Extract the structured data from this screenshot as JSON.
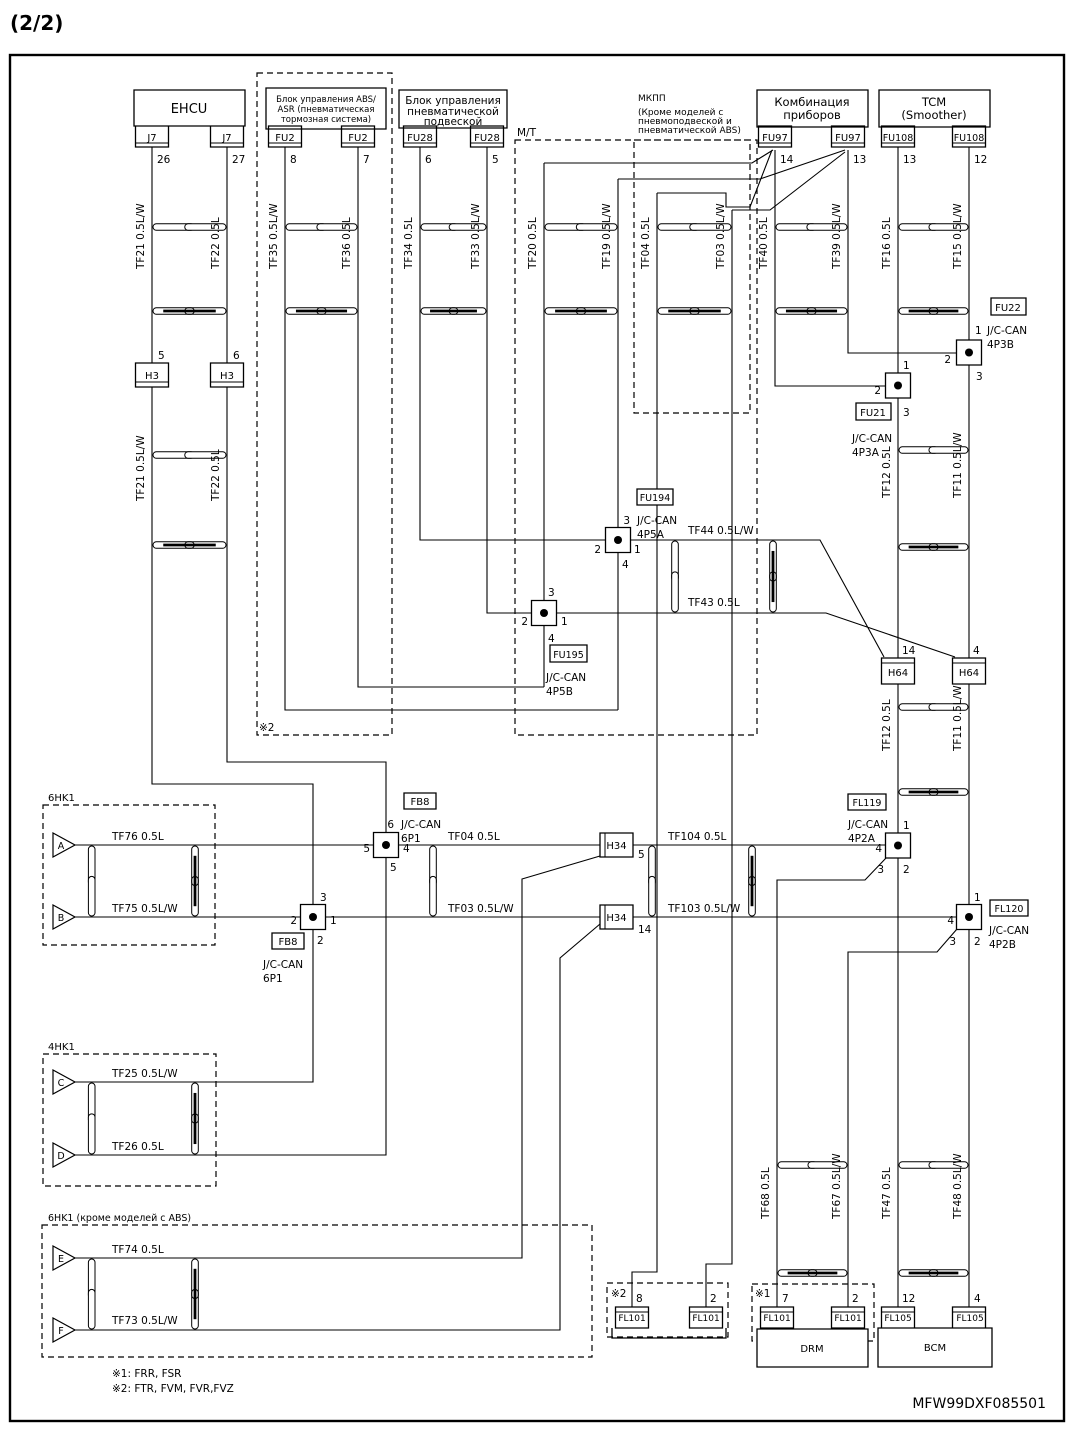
{
  "labels": [
    {
      "n": "sheet-number",
      "t": "(2/2)",
      "x": 10,
      "y": 30,
      "s": 20,
      "b": 1
    },
    {
      "n": "ehcu-label",
      "t": "EHCU",
      "x": 189,
      "y": 113,
      "a": "m",
      "s": 13
    },
    {
      "n": "abs-unit-line1",
      "t": "Блок управления ABS/",
      "x": 326,
      "y": 102,
      "a": "m",
      "s": 8.5
    },
    {
      "n": "abs-unit-line2",
      "t": "ASR (пневматическая",
      "x": 326,
      "y": 112,
      "a": "m",
      "s": 8.5
    },
    {
      "n": "abs-unit-line3",
      "t": "тормозная система)",
      "x": 326,
      "y": 122,
      "a": "m",
      "s": 8.5
    },
    {
      "n": "susp-unit-line1",
      "t": "Блок управления",
      "x": 453,
      "y": 104,
      "a": "m",
      "s": 10.5
    },
    {
      "n": "susp-unit-line2",
      "t": "пневматической",
      "x": 453,
      "y": 115,
      "a": "m",
      "s": 10.5
    },
    {
      "n": "susp-unit-line3",
      "t": "подвеской",
      "x": 453,
      "y": 125,
      "a": "m",
      "s": 10.5
    },
    {
      "n": "cluster-line1",
      "t": "Комбинация",
      "x": 812,
      "y": 106,
      "a": "m",
      "s": 11.5
    },
    {
      "n": "cluster-line2",
      "t": "приборов",
      "x": 812,
      "y": 119,
      "a": "m",
      "s": 11.5
    },
    {
      "n": "tcm-line1",
      "t": "TCM",
      "x": 934,
      "y": 106,
      "a": "m",
      "s": 11.5
    },
    {
      "n": "tcm-line2",
      "t": "(Smoother)",
      "x": 934,
      "y": 119,
      "a": "m",
      "s": 11.5
    },
    {
      "n": "mt-option-label",
      "t": "М/Т",
      "x": 517,
      "y": 136
    },
    {
      "n": "mkpp-option-line1",
      "t": "МКПП",
      "x": 638,
      "y": 101,
      "s": 9
    },
    {
      "n": "mkpp-option-line2",
      "t": "(Кроме моделей с",
      "x": 638,
      "y": 115,
      "s": 9
    },
    {
      "n": "mkpp-option-line3",
      "t": "пневмоподвеской и",
      "x": 638,
      "y": 124,
      "s": 9
    },
    {
      "n": "mkpp-option-line4",
      "t": "пневматической ABS)",
      "x": 638,
      "y": 133,
      "s": 9
    },
    {
      "n": "connector-j7-a",
      "t": "J7",
      "x": 152,
      "y": 141,
      "a": "m",
      "s": 10
    },
    {
      "n": "connector-j7-b",
      "t": "J7",
      "x": 227,
      "y": 141,
      "a": "m",
      "s": 10
    },
    {
      "n": "connector-fu2-a",
      "t": "FU2",
      "x": 285,
      "y": 141,
      "a": "m",
      "s": 10
    },
    {
      "n": "connector-fu2-b",
      "t": "FU2",
      "x": 358,
      "y": 141,
      "a": "m",
      "s": 10
    },
    {
      "n": "connector-fu28-a",
      "t": "FU28",
      "x": 420,
      "y": 141,
      "a": "m",
      "s": 10
    },
    {
      "n": "connector-fu28-b",
      "t": "FU28",
      "x": 487,
      "y": 141,
      "a": "m",
      "s": 10
    },
    {
      "n": "connector-fu97-a",
      "t": "FU97",
      "x": 775,
      "y": 141,
      "a": "m",
      "s": 10
    },
    {
      "n": "connector-fu97-b",
      "t": "FU97",
      "x": 848,
      "y": 141,
      "a": "m",
      "s": 10
    },
    {
      "n": "connector-fu108-a",
      "t": "FU108",
      "x": 898,
      "y": 141,
      "a": "m",
      "s": 9.5
    },
    {
      "n": "connector-fu108-b",
      "t": "FU108",
      "x": 969,
      "y": 141,
      "a": "m",
      "s": 9.5
    },
    {
      "n": "pin-26",
      "t": "26",
      "x": 157,
      "y": 163
    },
    {
      "n": "pin-27",
      "t": "27",
      "x": 232,
      "y": 163
    },
    {
      "n": "pin-8",
      "t": "8",
      "x": 290,
      "y": 163
    },
    {
      "n": "pin-7",
      "t": "7",
      "x": 363,
      "y": 163
    },
    {
      "n": "pin-6",
      "t": "6",
      "x": 425,
      "y": 163
    },
    {
      "n": "pin-5",
      "t": "5",
      "x": 492,
      "y": 163
    },
    {
      "n": "pin-14",
      "t": "14",
      "x": 780,
      "y": 163
    },
    {
      "n": "pin-13-cluster",
      "t": "13",
      "x": 853,
      "y": 163
    },
    {
      "n": "pin-13-tcm",
      "t": "13",
      "x": 903,
      "y": 163
    },
    {
      "n": "pin-12",
      "t": "12",
      "x": 974,
      "y": 163
    },
    {
      "n": "wire-tf21-upper",
      "t": "TF21 0.5L/W",
      "x": 144,
      "y": 269,
      "r": 1
    },
    {
      "n": "wire-tf22-upper",
      "t": "TF22 0.5L",
      "x": 219,
      "y": 269,
      "r": 1
    },
    {
      "n": "wire-tf35",
      "t": "TF35 0.5L/W",
      "x": 277,
      "y": 269,
      "r": 1
    },
    {
      "n": "wire-tf36",
      "t": "TF36 0.5L",
      "x": 350,
      "y": 269,
      "r": 1
    },
    {
      "n": "wire-tf34",
      "t": "TF34 0.5L",
      "x": 412,
      "y": 269,
      "r": 1
    },
    {
      "n": "wire-tf33",
      "t": "TF33 0.5L/W",
      "x": 479,
      "y": 269,
      "r": 1
    },
    {
      "n": "wire-tf20",
      "t": "TF20 0.5L",
      "x": 536,
      "y": 269,
      "r": 1
    },
    {
      "n": "wire-tf19",
      "t": "TF19 0.5L/W",
      "x": 610,
      "y": 269,
      "r": 1
    },
    {
      "n": "wire-tf04-option",
      "t": "TF04 0.5L",
      "x": 649,
      "y": 269,
      "r": 1
    },
    {
      "n": "wire-tf03-option",
      "t": "TF03 0.5L/W",
      "x": 724,
      "y": 269,
      "r": 1
    },
    {
      "n": "wire-tf40",
      "t": "TF40 0.5L",
      "x": 767,
      "y": 269,
      "r": 1
    },
    {
      "n": "wire-tf39",
      "t": "TF39 0.5L/W",
      "x": 840,
      "y": 269,
      "r": 1
    },
    {
      "n": "wire-tf16",
      "t": "TF16 0.5L",
      "x": 890,
      "y": 269,
      "r": 1
    },
    {
      "n": "wire-tf15",
      "t": "TF15 0.5L/W",
      "x": 961,
      "y": 269,
      "r": 1
    },
    {
      "n": "connector-h3-a",
      "t": "H3",
      "x": 152,
      "y": 379,
      "a": "m",
      "s": 10
    },
    {
      "n": "connector-h3-b",
      "t": "H3",
      "x": 227,
      "y": 379,
      "a": "m",
      "s": 10
    },
    {
      "n": "pin-5-h3",
      "t": "5",
      "x": 158,
      "y": 359
    },
    {
      "n": "pin-6-h3",
      "t": "6",
      "x": 233,
      "y": 359
    },
    {
      "n": "wire-tf21-lower",
      "t": "TF21 0.5L/W",
      "x": 144,
      "y": 501,
      "r": 1
    },
    {
      "n": "wire-tf22-lower",
      "t": "TF22 0.5L",
      "x": 219,
      "y": 501,
      "r": 1
    },
    {
      "n": "junction-fu22-label",
      "t": "FU22",
      "x": 1008,
      "y": 311,
      "a": "m",
      "s": 10
    },
    {
      "n": "fu22-pin-1",
      "t": "1",
      "x": 975,
      "y": 334
    },
    {
      "n": "fu22-jccan",
      "t": "J/C-CAN",
      "x": 987,
      "y": 334
    },
    {
      "n": "fu22-circuit",
      "t": "4P3B",
      "x": 987,
      "y": 348
    },
    {
      "n": "fu22-pin-2",
      "t": "2",
      "x": 951,
      "y": 363,
      "a": "e"
    },
    {
      "n": "fu22-pin-3",
      "t": "3",
      "x": 976,
      "y": 380
    },
    {
      "n": "junction-fu21-label",
      "t": "FU21",
      "x": 873,
      "y": 416,
      "a": "m",
      "s": 10
    },
    {
      "n": "fu21-pin-1",
      "t": "1",
      "x": 903,
      "y": 369
    },
    {
      "n": "fu21-pin-2",
      "t": "2",
      "x": 881,
      "y": 394,
      "a": "e"
    },
    {
      "n": "fu21-pin-3",
      "t": "3",
      "x": 903,
      "y": 416
    },
    {
      "n": "fu21-jccan",
      "t": "J/C-CAN",
      "x": 852,
      "y": 442
    },
    {
      "n": "fu21-circuit",
      "t": "4P3A",
      "x": 852,
      "y": 456
    },
    {
      "n": "wire-tf12-upper",
      "t": "TF12 0.5L",
      "x": 890,
      "y": 498,
      "r": 1
    },
    {
      "n": "wire-tf11-upper",
      "t": "TF11 0.5L/W",
      "x": 961,
      "y": 498,
      "r": 1
    },
    {
      "n": "junction-fu194-label",
      "t": "FU194",
      "x": 655,
      "y": 501,
      "a": "m",
      "s": 9.5
    },
    {
      "n": "fu194-pin-3",
      "t": "3",
      "x": 630,
      "y": 524,
      "a": "e"
    },
    {
      "n": "fu194-jccan",
      "t": "J/C-CAN",
      "x": 637,
      "y": 524
    },
    {
      "n": "fu194-circuit",
      "t": "4P5A",
      "x": 637,
      "y": 538
    },
    {
      "n": "fu194-pin-2",
      "t": "2",
      "x": 601,
      "y": 553,
      "a": "e"
    },
    {
      "n": "fu194-pin-1",
      "t": "1",
      "x": 634,
      "y": 553
    },
    {
      "n": "fu194-pin-4",
      "t": "4",
      "x": 622,
      "y": 568
    },
    {
      "n": "wire-tf44",
      "t": "TF44 0.5L/W",
      "x": 688,
      "y": 534
    },
    {
      "n": "wire-tf43",
      "t": "TF43 0.5L",
      "x": 688,
      "y": 606
    },
    {
      "n": "fu195-pin-3",
      "t": "3",
      "x": 548,
      "y": 596
    },
    {
      "n": "junction-fu195-label",
      "t": "FU195",
      "x": 568.5,
      "y": 658,
      "a": "m",
      "s": 9.5
    },
    {
      "n": "fu195-pin-2",
      "t": "2",
      "x": 528,
      "y": 625,
      "a": "e"
    },
    {
      "n": "fu195-pin-1",
      "t": "1",
      "x": 561,
      "y": 625
    },
    {
      "n": "fu195-pin-4",
      "t": "4",
      "x": 548,
      "y": 642
    },
    {
      "n": "fu195-jccan",
      "t": "J/C-CAN",
      "x": 546,
      "y": 681
    },
    {
      "n": "fu195-circuit",
      "t": "4P5B",
      "x": 546,
      "y": 695
    },
    {
      "n": "connector-h64-a",
      "t": "H64",
      "x": 898,
      "y": 676,
      "a": "m",
      "s": 10
    },
    {
      "n": "connector-h64-b",
      "t": "H64",
      "x": 969,
      "y": 676,
      "a": "m",
      "s": 10
    },
    {
      "n": "pin-14-h64",
      "t": "14",
      "x": 902,
      "y": 654
    },
    {
      "n": "pin-4-h64",
      "t": "4",
      "x": 973,
      "y": 654
    },
    {
      "n": "wire-tf12-lower",
      "t": "TF12 0.5L",
      "x": 890,
      "y": 751,
      "r": 1
    },
    {
      "n": "wire-tf11-lower",
      "t": "TF11 0.5L/W",
      "x": 961,
      "y": 751,
      "r": 1
    },
    {
      "n": "junction-fl119-label",
      "t": "FL119",
      "x": 867,
      "y": 806,
      "a": "m",
      "s": 9.5
    },
    {
      "n": "fl119-jccan",
      "t": "J/C-CAN",
      "x": 848,
      "y": 828
    },
    {
      "n": "fl119-circuit",
      "t": "4P2A",
      "x": 848,
      "y": 842
    },
    {
      "n": "fl119-pin-1",
      "t": "1",
      "x": 903,
      "y": 829
    },
    {
      "n": "fl119-pin-4",
      "t": "4",
      "x": 882,
      "y": 852,
      "a": "e"
    },
    {
      "n": "fl119-pin-3",
      "t": "3",
      "x": 884,
      "y": 873,
      "a": "e"
    },
    {
      "n": "fl119-pin-2",
      "t": "2",
      "x": 903,
      "y": 873
    },
    {
      "n": "junction-fl120-label",
      "t": "FL120",
      "x": 1009,
      "y": 912,
      "a": "m",
      "s": 9.5
    },
    {
      "n": "fl120-pin-1",
      "t": "1",
      "x": 974,
      "y": 901
    },
    {
      "n": "fl120-pin-4",
      "t": "4",
      "x": 954,
      "y": 924,
      "a": "e"
    },
    {
      "n": "fl120-pin-3",
      "t": "3",
      "x": 956,
      "y": 945,
      "a": "e"
    },
    {
      "n": "fl120-pin-2",
      "t": "2",
      "x": 974,
      "y": 945
    },
    {
      "n": "fl120-jccan",
      "t": "J/C-CAN",
      "x": 989,
      "y": 934
    },
    {
      "n": "fl120-circuit",
      "t": "4P2B",
      "x": 989,
      "y": 948
    },
    {
      "n": "junction-fb8-top-label",
      "t": "FB8",
      "x": 420,
      "y": 805,
      "a": "m",
      "s": 10
    },
    {
      "n": "fb8t-pin-6",
      "t": "6",
      "x": 394,
      "y": 828,
      "a": "e"
    },
    {
      "n": "fb8t-jccan",
      "t": "J/C-CAN",
      "x": 401,
      "y": 828
    },
    {
      "n": "fb8t-circuit",
      "t": "6P1",
      "x": 401,
      "y": 842
    },
    {
      "n": "fb8t-pin-5l",
      "t": "5",
      "x": 370,
      "y": 852,
      "a": "e"
    },
    {
      "n": "fb8t-pin-4",
      "t": "4",
      "x": 403,
      "y": 852
    },
    {
      "n": "fb8t-pin-5b",
      "t": "5",
      "x": 390,
      "y": 871
    },
    {
      "n": "fb8b-pin-3",
      "t": "3",
      "x": 320,
      "y": 901
    },
    {
      "n": "junction-fb8-bottom-label",
      "t": "FB8",
      "x": 288,
      "y": 945,
      "a": "m",
      "s": 10
    },
    {
      "n": "fb8b-pin-2l",
      "t": "2",
      "x": 297,
      "y": 924,
      "a": "e"
    },
    {
      "n": "fb8b-pin-1",
      "t": "1",
      "x": 330,
      "y": 924
    },
    {
      "n": "fb8b-pin-2b",
      "t": "2",
      "x": 317,
      "y": 944
    },
    {
      "n": "fb8b-jccan",
      "t": "J/C-CAN",
      "x": 263,
      "y": 968
    },
    {
      "n": "fb8b-circuit",
      "t": "6P1",
      "x": 263,
      "y": 982
    },
    {
      "n": "connector-h34-a",
      "t": "H34",
      "x": 616.5,
      "y": 849,
      "a": "m",
      "s": 10
    },
    {
      "n": "connector-h34-b",
      "t": "H34",
      "x": 616.5,
      "y": 921,
      "a": "m",
      "s": 10
    },
    {
      "n": "pin-5-h34",
      "t": "5",
      "x": 638,
      "y": 858
    },
    {
      "n": "pin-14-h34",
      "t": "14",
      "x": 638,
      "y": 933
    },
    {
      "n": "wire-tf04-main",
      "t": "TF04 0.5L",
      "x": 448,
      "y": 840
    },
    {
      "n": "wire-tf03-main",
      "t": "TF03 0.5L/W",
      "x": 448,
      "y": 912
    },
    {
      "n": "wire-tf104",
      "t": "TF104 0.5L",
      "x": 668,
      "y": 840
    },
    {
      "n": "wire-tf103",
      "t": "TF103 0.5L/W",
      "x": 668,
      "y": 912
    },
    {
      "n": "label-6hk1",
      "t": "6HK1",
      "x": 48,
      "y": 801,
      "s": 10
    },
    {
      "n": "triangle-a-letter",
      "t": "A",
      "x": 61,
      "y": 849,
      "a": "m",
      "s": 9.5
    },
    {
      "n": "triangle-b-letter",
      "t": "B",
      "x": 61,
      "y": 921,
      "a": "m",
      "s": 9.5
    },
    {
      "n": "wire-tf76",
      "t": "TF76 0.5L",
      "x": 112,
      "y": 840
    },
    {
      "n": "wire-tf75",
      "t": "TF75 0.5L/W",
      "x": 112,
      "y": 912
    },
    {
      "n": "label-4hk1",
      "t": "4HK1",
      "x": 48,
      "y": 1050,
      "s": 10
    },
    {
      "n": "triangle-c-letter",
      "t": "C",
      "x": 61,
      "y": 1086,
      "a": "m",
      "s": 9.5
    },
    {
      "n": "triangle-d-letter",
      "t": "D",
      "x": 61,
      "y": 1159,
      "a": "m",
      "s": 9.5
    },
    {
      "n": "wire-tf25",
      "t": "TF25 0.5L/W",
      "x": 112,
      "y": 1077
    },
    {
      "n": "wire-tf26",
      "t": "TF26 0.5L",
      "x": 112,
      "y": 1150
    },
    {
      "n": "label-6hk1-no-abs",
      "t": "6HK1 (кроме моделей с ABS)",
      "x": 48,
      "y": 1221,
      "s": 9.5
    },
    {
      "n": "triangle-e-letter",
      "t": "E",
      "x": 61,
      "y": 1262,
      "a": "m",
      "s": 9.5
    },
    {
      "n": "triangle-f-letter",
      "t": "F",
      "x": 61,
      "y": 1334,
      "a": "m",
      "s": 9.5
    },
    {
      "n": "wire-tf74",
      "t": "TF74 0.5L",
      "x": 112,
      "y": 1253
    },
    {
      "n": "wire-tf73",
      "t": "TF73 0.5L/W",
      "x": 112,
      "y": 1324
    },
    {
      "n": "note-mark-abs",
      "t": "※2",
      "x": 259,
      "y": 731
    },
    {
      "n": "note-mark-fl101",
      "t": "※2",
      "x": 611,
      "y": 1297
    },
    {
      "n": "pin-8-fl101",
      "t": "8",
      "x": 636,
      "y": 1302
    },
    {
      "n": "connector-fl101-a",
      "t": "FL101",
      "x": 632,
      "y": 1321,
      "a": "m",
      "s": 9
    },
    {
      "n": "pin-2-fl101-a",
      "t": "2",
      "x": 710,
      "y": 1302
    },
    {
      "n": "connector-fl101-b",
      "t": "FL101",
      "x": 706,
      "y": 1321,
      "a": "m",
      "s": 9
    },
    {
      "n": "note-mark-drm",
      "t": "※1",
      "x": 755,
      "y": 1297
    },
    {
      "n": "pin-7-fl101",
      "t": "7",
      "x": 782,
      "y": 1302
    },
    {
      "n": "connector-fl101-c",
      "t": "FL101",
      "x": 777,
      "y": 1321,
      "a": "m",
      "s": 9
    },
    {
      "n": "pin-2-fl101-b",
      "t": "2",
      "x": 852,
      "y": 1302
    },
    {
      "n": "connector-fl101-d",
      "t": "FL101",
      "x": 848,
      "y": 1321,
      "a": "m",
      "s": 9
    },
    {
      "n": "drm-label",
      "t": "DRM",
      "x": 812,
      "y": 1352,
      "a": "m",
      "s": 10
    },
    {
      "n": "pin-12-fl105",
      "t": "12",
      "x": 902,
      "y": 1302
    },
    {
      "n": "connector-fl105-a",
      "t": "FL105",
      "x": 898,
      "y": 1321,
      "a": "m",
      "s": 9
    },
    {
      "n": "pin-4-fl105",
      "t": "4",
      "x": 974,
      "y": 1302
    },
    {
      "n": "connector-fl105-b",
      "t": "FL105",
      "x": 970,
      "y": 1321,
      "a": "m",
      "s": 9
    },
    {
      "n": "bcm-label",
      "t": "BCM",
      "x": 935,
      "y": 1351,
      "a": "m",
      "s": 10
    },
    {
      "n": "wire-tf68",
      "t": "TF68 0.5L",
      "x": 769,
      "y": 1219,
      "r": 1
    },
    {
      "n": "wire-tf67",
      "t": "TF67 0.5L/W",
      "x": 840,
      "y": 1219,
      "r": 1
    },
    {
      "n": "wire-tf47",
      "t": "TF47 0.5L",
      "x": 890,
      "y": 1219,
      "r": 1
    },
    {
      "n": "wire-tf48",
      "t": "TF48 0.5L/W",
      "x": 961,
      "y": 1219,
      "r": 1
    },
    {
      "n": "footnote-1",
      "t": "※1: FRR, FSR",
      "x": 112,
      "y": 1377
    },
    {
      "n": "footnote-2",
      "t": "※2: FTR, FVM, FVR,FVZ",
      "x": 112,
      "y": 1392
    },
    {
      "n": "drawing-number",
      "t": "MFW99DXF085501",
      "x": 1046,
      "y": 1408,
      "a": "e",
      "s": 14
    }
  ]
}
